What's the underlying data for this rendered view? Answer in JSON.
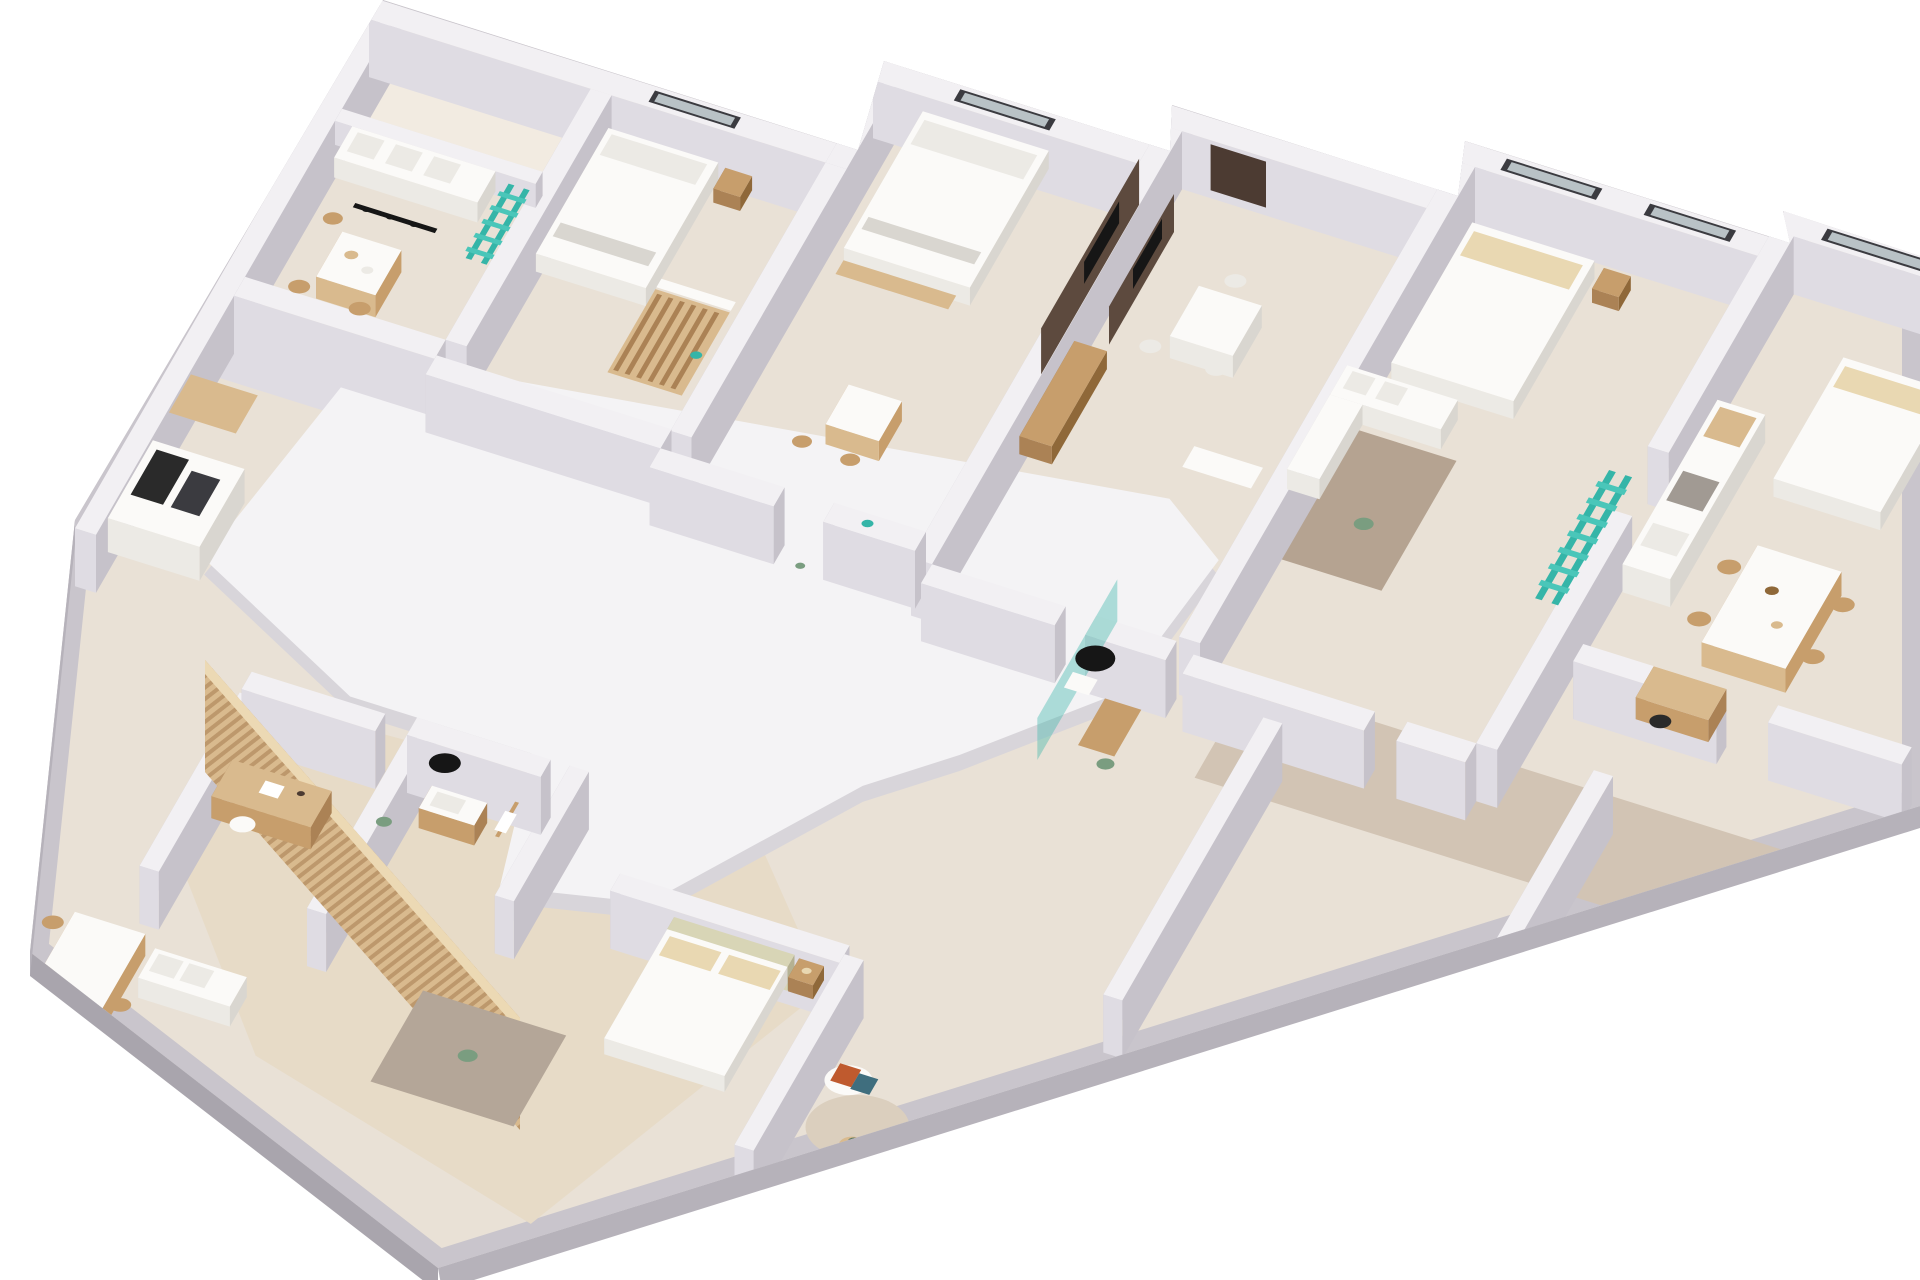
{
  "meta": {
    "type": "3d-floor-plan-render",
    "view": "axonometric cutaway",
    "background": "#ffffff",
    "description": "White-walled multi-unit apartment floor with beige floors, white furniture, wood accents and teal ladders"
  },
  "palette": {
    "bg": "#ffffff",
    "outerBand": "#c9c5cc",
    "outerFace1": "#b6b2ba",
    "outerFace2": "#a9a5ad",
    "wallTop": "#f2f0f3",
    "wallFaceLight": "#dfdce3",
    "wallFaceDark": "#c6c2ca",
    "floorBase": "#e9e1d6",
    "floorTerrace": "#f2ebe1",
    "floorWood": "#e7dbc7",
    "floorCarpet": "#d2c4b4",
    "slabTop": "#f4f3f5",
    "slabSide": "#d8d5da",
    "rugBrown": "#b5a391",
    "rugGray": "#b4a698",
    "rugRound": "#dbcfbe",
    "furnWhite": "#fbfaf8",
    "furnWhiteSide": "#eceae5",
    "furnWhiteDark": "#d9d6d0",
    "pillowCream": "#e9d8b2",
    "headboardSage": "#d8d5b6",
    "sageDark": "#b5b192",
    "woodLight": "#d9ba8e",
    "wood": "#c79e6c",
    "woodMid": "#ab8255",
    "woodDark": "#8f6839",
    "woodWall": "#5d4a3e",
    "doorBrown": "#4c3b32",
    "black": "#161616",
    "glassDark": "#3b3b40",
    "glassLight": "#b9c2c6",
    "teal": "#35b5a8",
    "tealLight": "#4ac6b9",
    "orange": "#bf5a2e",
    "blueTeal": "#3f6e7e",
    "blueLight": "#a9d3d3",
    "plantGreen": "#7a9d80",
    "plantDark": "#5d7a62",
    "range": "#a19a93",
    "appliance": "#2a2a2a"
  },
  "scene": {
    "building": "apartment-floor",
    "units": [
      {
        "id": "unit-top-left",
        "rooms": [
          "terrace",
          "living-dining"
        ],
        "furniture": [
          "white-sofa",
          "track-pendant-light",
          "dining-table",
          "wood-chairs",
          "teal-ladder"
        ]
      },
      {
        "id": "unit-bedroom-2",
        "furniture": [
          "double-bed",
          "nightstand",
          "slatted-wardrobe",
          "teal-decor"
        ]
      },
      {
        "id": "unit-bedroom-3",
        "furniture": [
          "double-bed",
          "bench",
          "tv-media-wall",
          "small-table"
        ]
      },
      {
        "id": "unit-living-2",
        "furniture": [
          "entry-door",
          "tv-media-wall",
          "sideboard",
          "white-dining-table"
        ]
      },
      {
        "id": "unit-bedroom-4",
        "furniture": [
          "double-bed-cream-pillows",
          "white-corner-sofa",
          "brown-rug",
          "plant"
        ]
      },
      {
        "id": "unit-kitchen-right",
        "furniture": [
          "kitchen-counter",
          "cooktop",
          "marble-dining-table",
          "wood-chairs",
          "double-bed",
          "desk",
          "desk-chair"
        ]
      },
      {
        "id": "core-center",
        "rooms": [
          "roof-slab",
          "hallway",
          "bathroom"
        ],
        "furniture": [
          "black-round-table",
          "shower-glass",
          "teal-ladder",
          "vanity",
          "hall-carpet"
        ]
      },
      {
        "id": "unit-bottom-left",
        "rooms": [
          "kitchen",
          "home-office",
          "bathroom",
          "bedroom",
          "lounge"
        ],
        "furniture": [
          "kitchen-counter",
          "oven",
          "desk",
          "office-chair",
          "round-black-mirror",
          "wood-vanity",
          "towel-rail",
          "sage-headboard-bed",
          "slatted-screen",
          "dining-table",
          "white-sofa",
          "wicker-armchairs",
          "orange-cushions",
          "teal-cushions",
          "coffee-table",
          "rugs",
          "plants"
        ]
      }
    ]
  }
}
